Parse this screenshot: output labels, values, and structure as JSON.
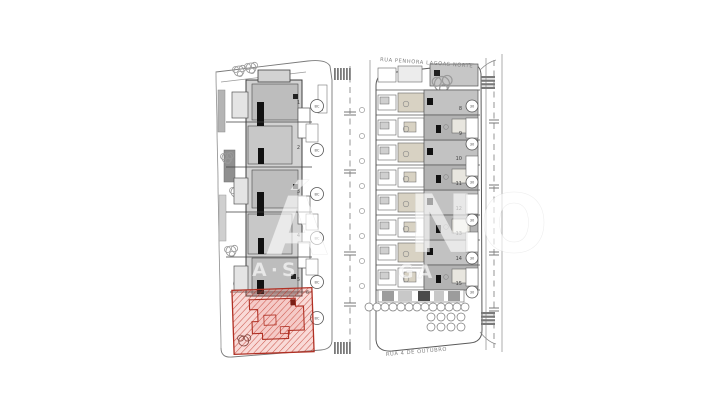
{
  "canvas": {
    "width": 707,
    "height": 420,
    "background": "#ffffff"
  },
  "site_plan": {
    "streets": {
      "top_label": "RUA PENHORA LAGOAS NORTE",
      "bottom_label": "RUA 4 DE OUTUBRO"
    },
    "watermark": {
      "big_left": "Á",
      "big_right": "NO",
      "sub_left": "A·S",
      "sub_right": "GA"
    },
    "left_block": {
      "vertical_label": "B08B",
      "units": [
        {
          "number": "1",
          "bay": "BC"
        },
        {
          "number": "2",
          "bay": "BC"
        },
        {
          "number": "3",
          "bay": "BC"
        },
        {
          "number": "4",
          "bay": "BC"
        },
        {
          "number": "5",
          "bay": "BC"
        },
        {
          "number": "6",
          "bay": "BC"
        }
      ],
      "highlighted_unit": "6"
    },
    "right_block": {
      "units": [
        {
          "number": "8"
        },
        {
          "number": "9"
        },
        {
          "number": "10"
        },
        {
          "number": "11"
        },
        {
          "number": "12"
        },
        {
          "number": "13"
        },
        {
          "number": "14"
        },
        {
          "number": "15"
        }
      ],
      "bay_circles": [
        "30",
        "30",
        "30",
        "30",
        "30",
        "30"
      ]
    },
    "colors": {
      "highlight_red": "#c0392b",
      "building_grey": "#d2d2d2",
      "roof_grey": "#bdbdbd",
      "beige": "#d8d2c3",
      "line_dark": "#3f3f3f",
      "line_light": "#8a8a8a"
    }
  }
}
